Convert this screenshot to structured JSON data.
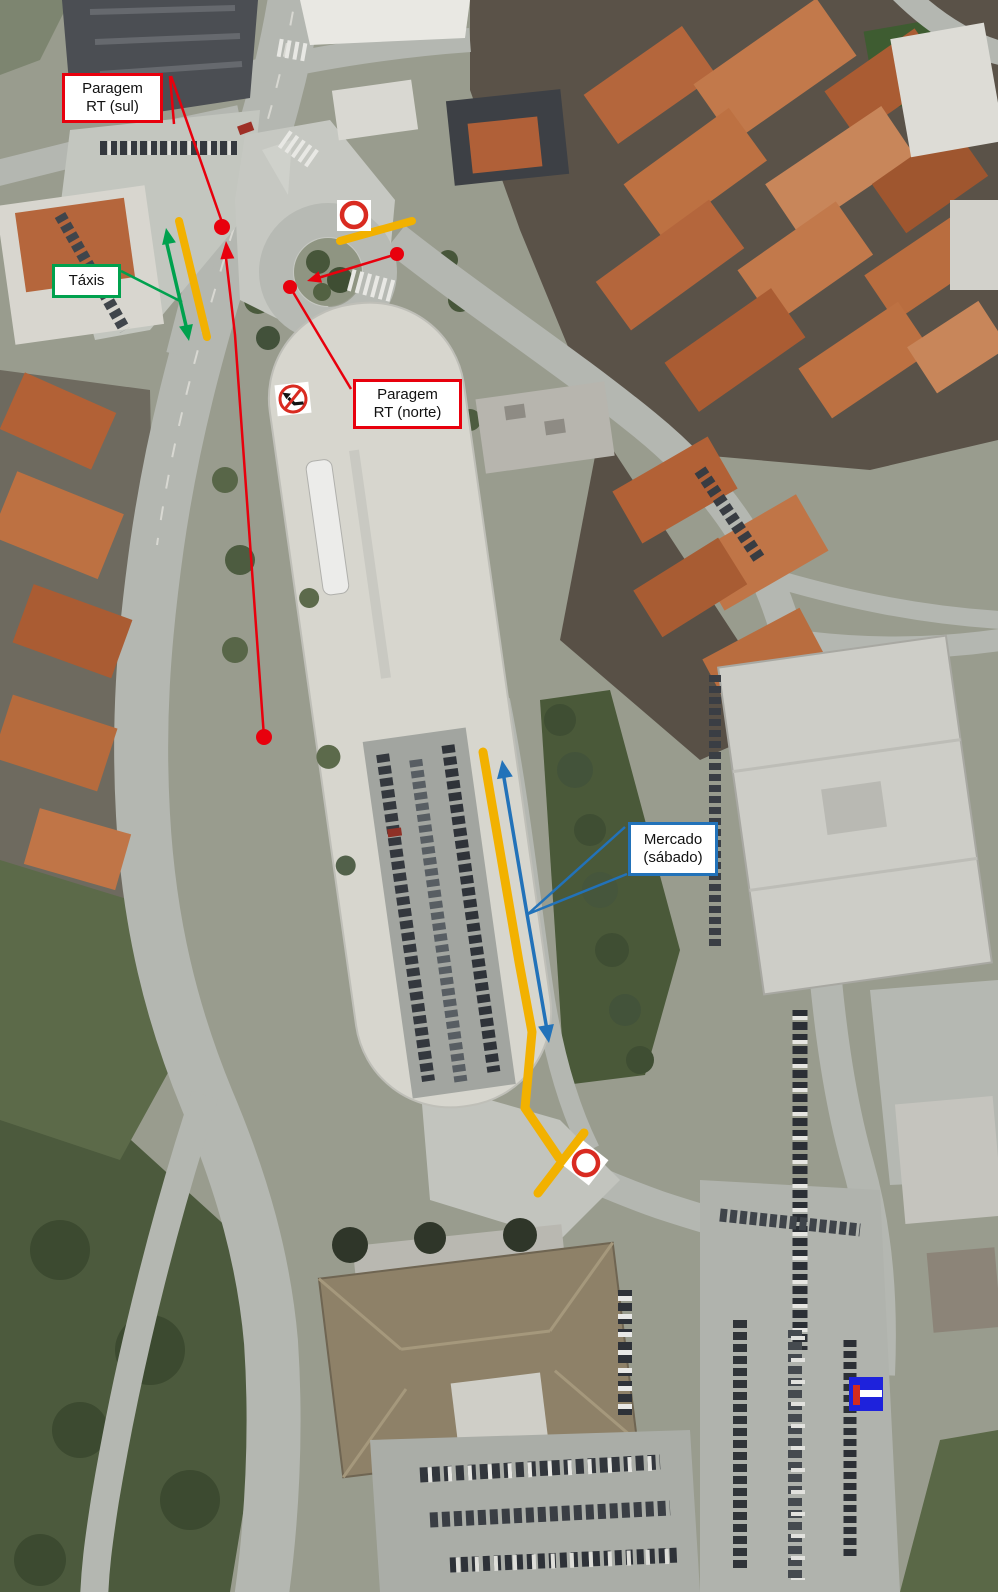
{
  "map": {
    "kind": "annotated satellite map"
  },
  "annotations": {
    "paragem_sul": {
      "line1": "Paragem",
      "line2": "RT (sul)"
    },
    "paragem_norte": {
      "line1": "Paragem",
      "line2": "RT (norte)"
    },
    "taxis": {
      "label": "Táxis"
    },
    "mercado": {
      "line1": "Mercado",
      "line2": "(sábado)"
    }
  },
  "signs": {
    "no_entry_north": "no-entry",
    "no_left_turn": "no-left-turn",
    "no_entry_south": "no-entry",
    "dead_end": "dead-end"
  },
  "colors": {
    "annotation_red": "#e8000d",
    "closure_yellow": "#f2b100",
    "taxi_green": "#00a14e",
    "market_blue": "#2272b9",
    "sign_red": "#d92b21",
    "sign_black": "#141414",
    "dead_end_blue": "#1e22dc",
    "dead_end_red": "#d42b1e",
    "dot_red": "#e8000d"
  }
}
